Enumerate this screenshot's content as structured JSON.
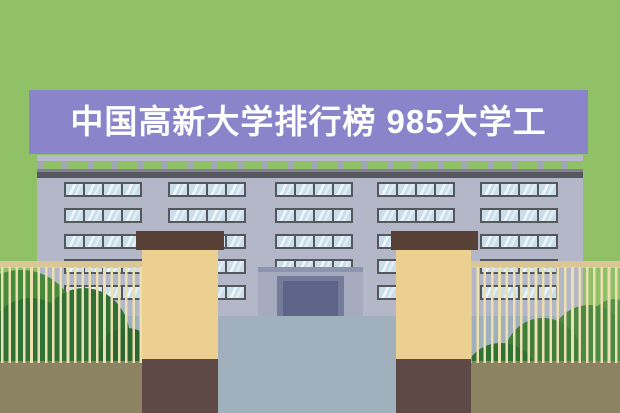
{
  "banner": {
    "title": "中国高新大学排行榜 985大学工",
    "bg_color": "#8a85cb",
    "text_color": "#ffffff"
  },
  "scene": {
    "description_labels": {
      "building": "university-building",
      "entrance": "entrance-gate"
    },
    "colors": {
      "background_green": "#91c166",
      "banner_purple": "#8a85cb",
      "title_text": "#ffffff",
      "parapet_gray": "#b5b9c9",
      "parapet_post": "#a3a7b5",
      "roof_shadow": "#7f838e",
      "roofline": "#57585f",
      "facade": "#b3b7c8",
      "window_frame": "#54585e",
      "window_glass": "#cbdfea",
      "plaza": "#a0b1bd",
      "porch_wall": "#a6abc0",
      "porch_lintel": "#8e94ad",
      "door_frame": "#747b9b",
      "door": "#5d6487",
      "pillar_cap": "#594036",
      "pillar_shaft": "#ebd092",
      "pillar_base": "#5f4947",
      "fence_rail": "#d9c795",
      "fence_post": "#ece0b1",
      "bush_dark": "#2f7034",
      "bush_darker": "#2b6831",
      "bush_mid": "#3f7f39",
      "bush_light": "#478a3c",
      "bush_light2": "#4a8a42",
      "bush_lightest": "#579249",
      "ground": "#8c8363"
    },
    "building": {
      "window_rows_y": [
        182,
        208,
        234,
        259,
        285
      ],
      "window_groups_x": [
        64,
        168,
        275,
        377,
        480
      ],
      "panes_per_group": 4,
      "group_width": 78,
      "row_height": 15
    }
  }
}
